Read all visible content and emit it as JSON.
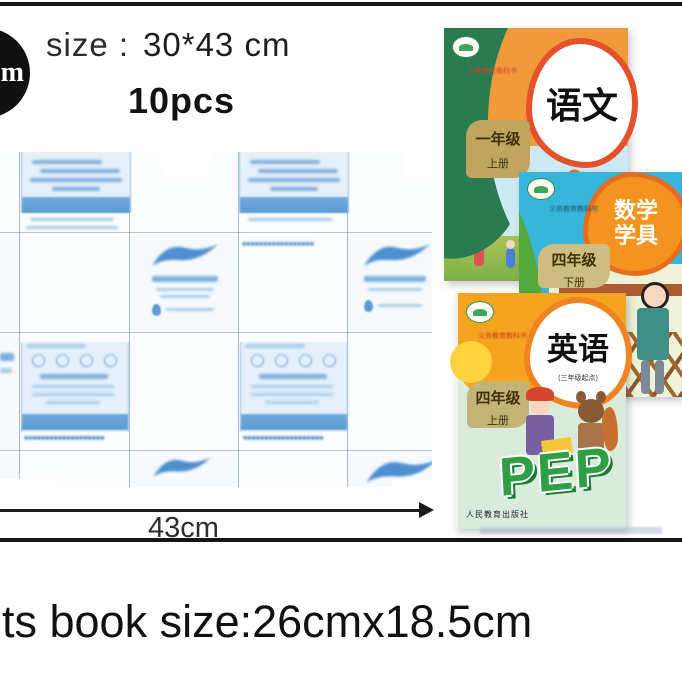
{
  "badge": {
    "text": "m",
    "bg": "#101010"
  },
  "header": {
    "size_label": "size :",
    "size_value": "30*43 cm",
    "quantity": "10pcs"
  },
  "sheet": {
    "width_label": "43cm",
    "grid_color": "#7698cd",
    "print_color": "#5b9bd5"
  },
  "footer": {
    "text": "its book size:26cmx18.5cm"
  },
  "books": [
    {
      "title": "语文",
      "series": "义务教育教科书",
      "grade": "一年级",
      "volume": "上册"
    },
    {
      "title_line1": "数学",
      "title_line2": "学具",
      "series": "义务教育教科书",
      "grade": "四年级",
      "volume": "下册"
    },
    {
      "title": "英语",
      "subtitle": "(三年级起点)",
      "series": "义务教育教科书",
      "grade": "四年级",
      "volume": "上册",
      "brand": "PEP",
      "publisher": "人民教育出版社"
    }
  ]
}
